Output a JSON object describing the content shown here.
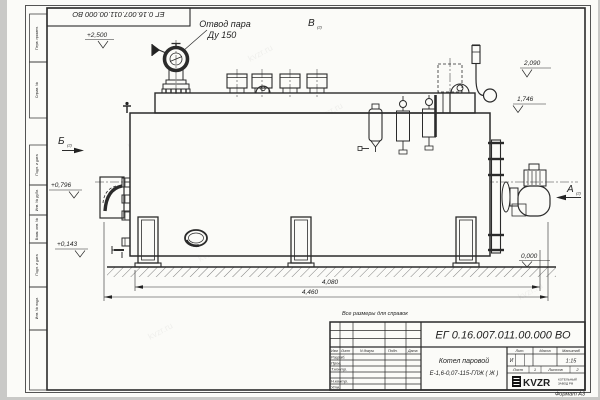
{
  "page": {
    "format_label": "Формат А3",
    "note": "Все размеры для справок",
    "watermark": "kvzr.ru"
  },
  "top_left_stamp": {
    "doc_number": "ЕГ 0.16.007.011.00.000  ВО"
  },
  "labels": {
    "steam_outlet_line1": "Отвод пара",
    "steam_outlet_line2": "Ду 150"
  },
  "views": {
    "a": "А",
    "b": "Б",
    "v": "В",
    "sheet_ref": "(2)"
  },
  "elevations": {
    "top_valve": "+2,500",
    "drum_top": "2,090",
    "drum_bottom": "1,746",
    "burner_axis": "+0,796",
    "lower": "+0,143",
    "ground": "0,000"
  },
  "dimensions": {
    "body_length": "4,080",
    "overall_length": "4,460"
  },
  "title_block": {
    "doc_number": "ЕГ 0.16.007.011.00.000  ВО",
    "product_name_line1": "Котел паровой",
    "product_name_line2": "Е-1,6-0,07-115-ГЛЖ ( Ж )",
    "headers": {
      "izm": "Изм",
      "list": "Лист",
      "ndoc": "N докум.",
      "podp": "Подп.",
      "data": "Дата",
      "lit": "Лит.",
      "massa": "Масса",
      "masshtab": "Масштаб"
    },
    "rows": [
      {
        "label": "Разраб."
      },
      {
        "label": "Пров."
      },
      {
        "label": "Т.контр."
      },
      {
        "label": ""
      },
      {
        "label": "Н.контр."
      },
      {
        "label": "Утв."
      }
    ],
    "lit_value": "И",
    "scale_value": "1:15",
    "sheet_label": "Лист",
    "sheet_value": "1",
    "sheets_label": "Листов",
    "sheets_value": "2",
    "org": {
      "logo": "KVZR",
      "sub1": "КОТЕЛЬНЫЙ",
      "sub2": "ЗАВОД РФ"
    }
  },
  "margin_column": {
    "labels": [
      "Перв. примен.",
      "Справ. №",
      "Подп. и дата",
      "Инв. № дубл.",
      "Взам. инв. №",
      "Подп. и дата",
      "Инв. № подл."
    ]
  }
}
